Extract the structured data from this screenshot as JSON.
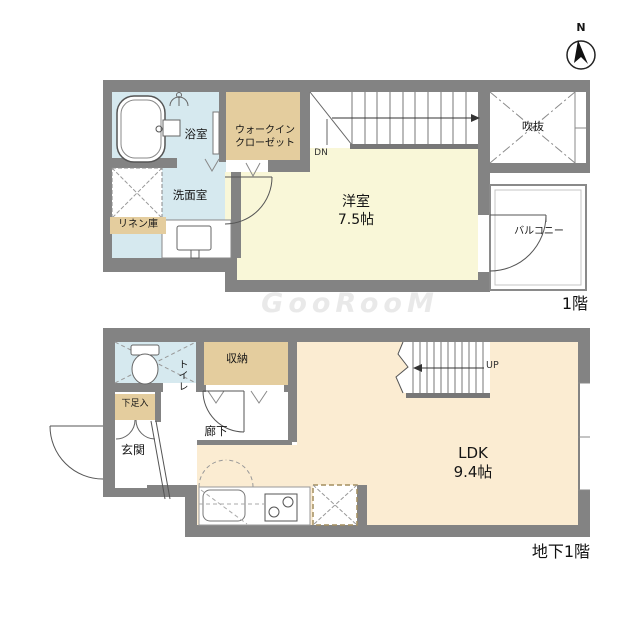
{
  "watermark": "GooRooM",
  "compass": {
    "north": "N"
  },
  "floor1": {
    "floor_label": "1階",
    "bathroom": "浴室",
    "walkin_closet_line1": "ウォークイン",
    "walkin_closet_line2": "クローゼット",
    "washroom": "洗面室",
    "linen_closet": "リネン庫",
    "bedroom_name": "洋室",
    "bedroom_size": "7.5帖",
    "stairs_down": "DN",
    "void": "吹抜",
    "balcony": "バルコニー"
  },
  "basement": {
    "floor_label": "地下1階",
    "toilet": "トイレ",
    "storage": "収納",
    "shoe_box": "下足入",
    "entrance": "玄関",
    "hallway": "廊下",
    "stairs_up": "UP",
    "ldk_name": "LDK",
    "ldk_size": "9.4帖"
  },
  "colors": {
    "wall": "#838383",
    "wet_area": "#d6e9ef",
    "closet": "#e4cd9e",
    "bedroom_floor": "#f9f7d8",
    "ldk_floor": "#fbecd2",
    "line": "#555555"
  }
}
